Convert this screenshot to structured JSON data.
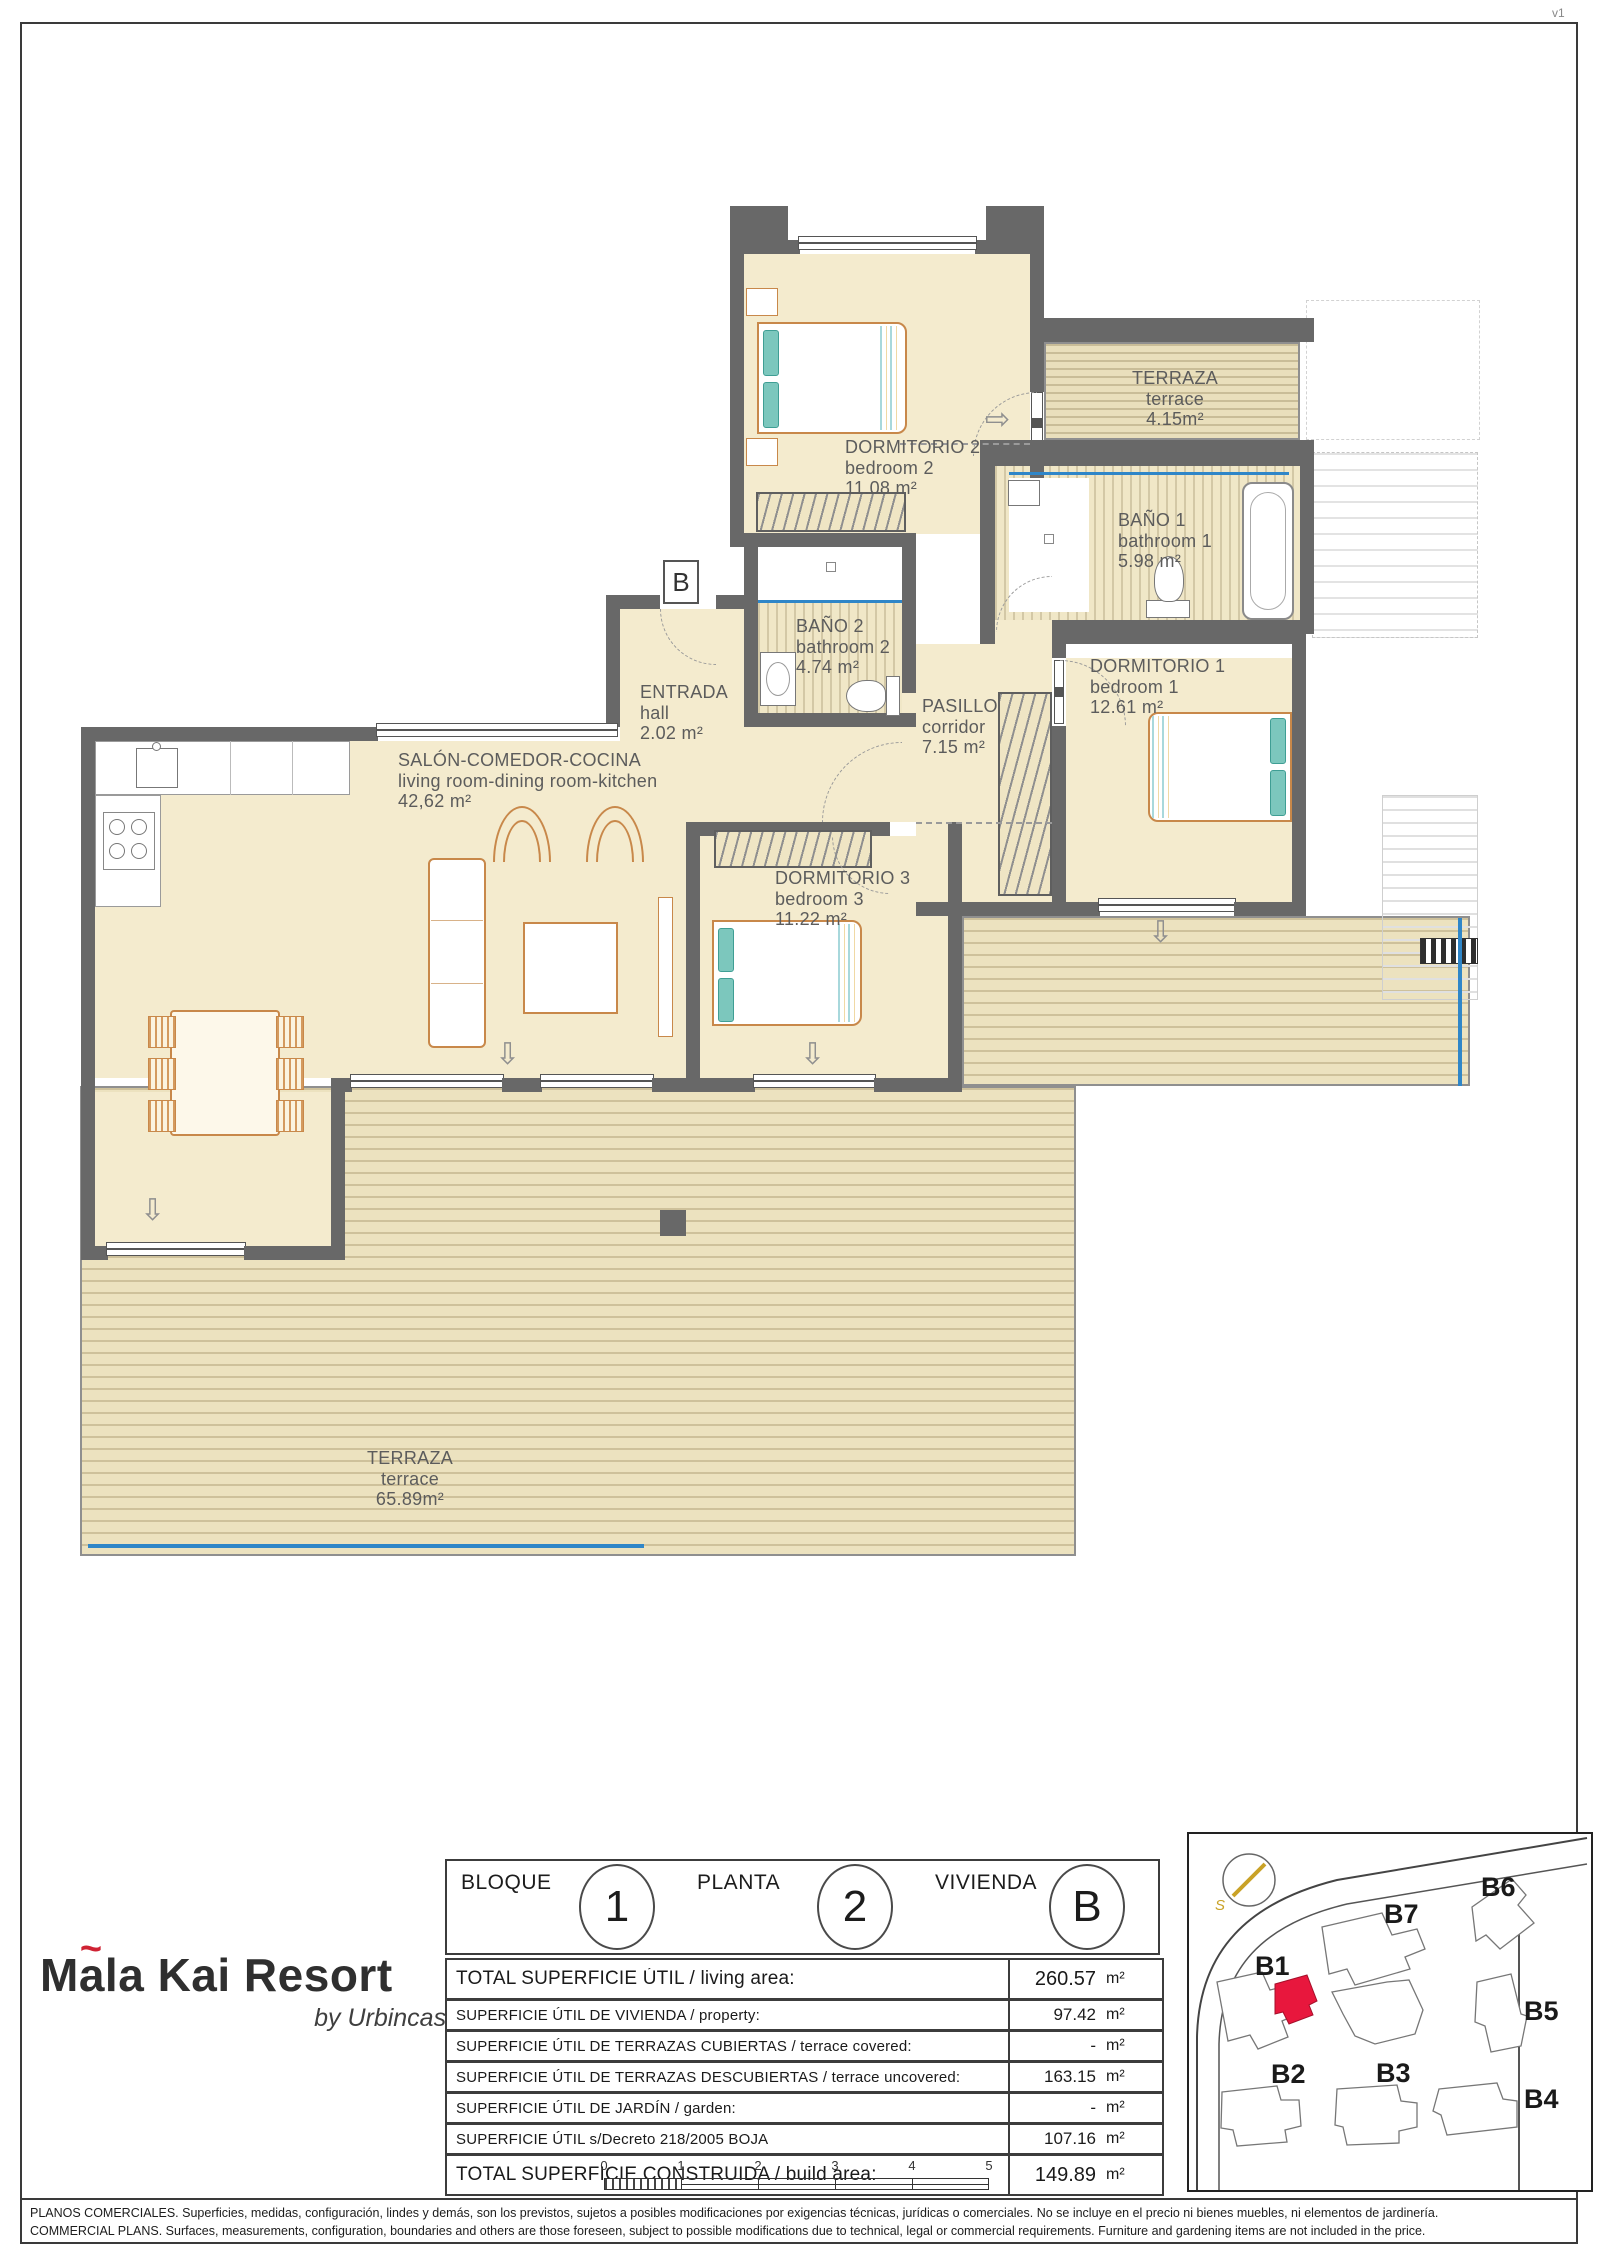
{
  "page": {
    "version": "v1"
  },
  "plan": {
    "badge": "B",
    "icons": {
      "arrow_right": "⇨",
      "arrow_down": "⇩"
    },
    "rooms": {
      "bedroom2": {
        "es": "DORMITORIO 2",
        "en": "bedroom 2",
        "area": "11.08 m²"
      },
      "terrace_top": {
        "es": "TERRAZA",
        "en": "terrace",
        "area": "4.15m²"
      },
      "bath1": {
        "es": "BAÑO 1",
        "en": "bathroom 1",
        "area": "5.98 m²"
      },
      "bath2": {
        "es": "BAÑO 2",
        "en": "bathroom 2",
        "area": "4.74 m²"
      },
      "entrance": {
        "es": "ENTRADA",
        "en": "hall",
        "area": "2.02 m²"
      },
      "corridor": {
        "es": "PASILLO",
        "en": "corridor",
        "area": "7.15 m²"
      },
      "bedroom1": {
        "es": "DORMITORIO 1",
        "en": "bedroom 1",
        "area": "12.61 m²"
      },
      "living": {
        "es": "SALÓN-COMEDOR-COCINA",
        "en": "living room-dining room-kitchen",
        "area": "42,62 m²"
      },
      "bedroom3": {
        "es": "DORMITORIO 3",
        "en": "bedroom 3",
        "area": "11.22 m²"
      },
      "terrace_main": {
        "es": "TERRAZA",
        "en": "terrace",
        "area": "65.89m²"
      }
    }
  },
  "legend": {
    "bloque": {
      "label": "BLOQUE",
      "value": "1"
    },
    "planta": {
      "label": "PLANTA",
      "value": "2"
    },
    "vivienda": {
      "label": "VIVIENDA",
      "value": "B"
    }
  },
  "table": {
    "rows": [
      {
        "label": "TOTAL SUPERFICIE ÚTIL / living area:",
        "value": "260.57",
        "unit": "m²"
      },
      {
        "label": "SUPERFICIE ÚTIL DE VIVIENDA / property:",
        "value": "97.42",
        "unit": "m²"
      },
      {
        "label": "SUPERFICIE ÚTIL DE TERRAZAS CUBIERTAS / terrace covered:",
        "value": "-",
        "unit": "m²"
      },
      {
        "label": "SUPERFICIE ÚTIL DE TERRAZAS DESCUBIERTAS / terrace uncovered:",
        "value": "163.15",
        "unit": "m²"
      },
      {
        "label": "SUPERFICIE ÚTIL DE JARDÍN / garden:",
        "value": "-",
        "unit": "m²"
      },
      {
        "label": "SUPERFICIE ÚTIL s/Decreto 218/2005 BOJA",
        "value": "107.16",
        "unit": "m²"
      },
      {
        "label": "TOTAL SUPERFICIE CONSTRUIDA / build area:",
        "value": "149.89",
        "unit": "m²"
      }
    ]
  },
  "logo": {
    "l1": "M",
    "l2": "a",
    "tilde": "~",
    "l3": "la Kai Resort",
    "byline": "by Urbincasa"
  },
  "siteplan": {
    "highlight_color": "#e8173d",
    "labels": {
      "b1": "B1",
      "b2": "B2",
      "b3": "B3",
      "b4": "B4",
      "b5": "B5",
      "b6": "B6",
      "b7": "B7"
    }
  },
  "scalebar": {
    "ticks": [
      "0",
      "1",
      "2",
      "3",
      "4",
      "5"
    ]
  },
  "disclaimer": {
    "line1": "PLANOS COMERCIALES. Superficies, medidas, configuración, lindes y demás, son los previstos, sujetos a posibles modificaciones por exigencias técnicas, jurídicas o comerciales. No se incluye en el precio ni bienes muebles, ni elementos de jardinería.",
    "line2": "COMMERCIAL PLANS. Surfaces, measurements, configuration, boundaries and others are those foreseen, subject to possible modifications due to technical, legal or commercial requirements. Furniture and gardening items are not included in the price."
  }
}
